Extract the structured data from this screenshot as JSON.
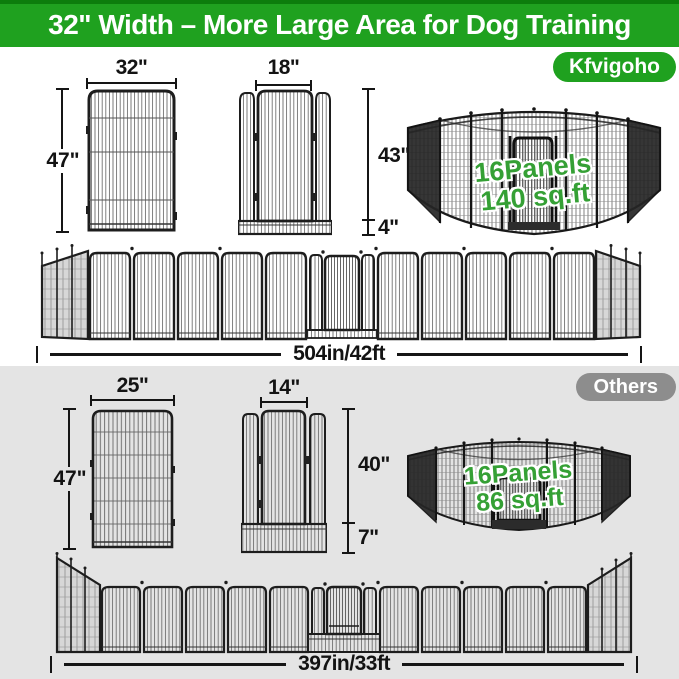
{
  "banner": {
    "title": "32\" Width – More Large Area for Dog Training"
  },
  "kfvigoho": {
    "badge_label": "Kfvigoho",
    "panel_diagram": {
      "width": "32\"",
      "height": "47\""
    },
    "door_diagram": {
      "door_width": "18\"",
      "door_height": "43\"",
      "base_height": "4\""
    },
    "pen_figure": {
      "panels": "16Panels",
      "area": "140 sq.ft"
    },
    "layout_total": "504in/42ft"
  },
  "others": {
    "badge_label": "Others",
    "panel_diagram": {
      "width": "25\"",
      "height": "47\""
    },
    "door_diagram": {
      "door_width": "14\"",
      "door_height": "40\"",
      "base_height": "7\""
    },
    "pen_figure": {
      "panels": "16Panels",
      "area": "86 sq.ft"
    },
    "layout_total": "397in/33ft"
  },
  "colors": {
    "banner_green": "#1fa11f",
    "banner_dark_green": "#0c7d0c",
    "badge_gray": "#8d8d8d",
    "section_gray": "#e4e4e4",
    "pen_text_green": "#35a035"
  }
}
